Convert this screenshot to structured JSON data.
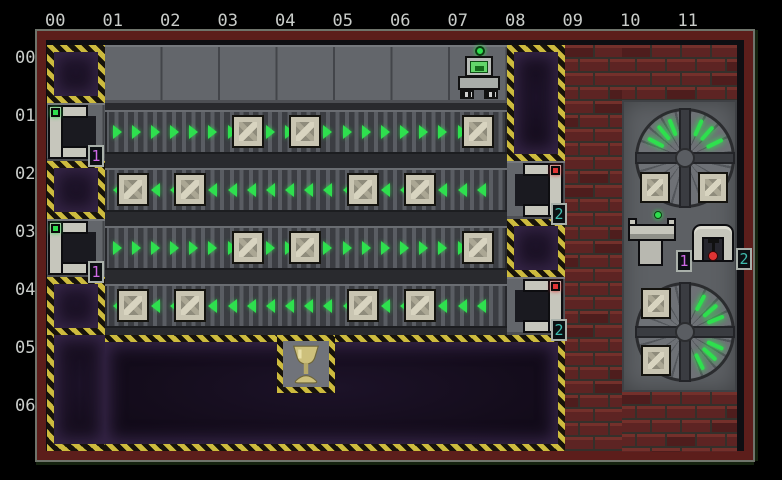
{
  "coordinates": {
    "columns": [
      "00",
      "01",
      "02",
      "03",
      "04",
      "05",
      "06",
      "07",
      "08",
      "09",
      "10",
      "11"
    ],
    "rows": [
      "00",
      "01",
      "02",
      "03",
      "04",
      "05",
      "06"
    ]
  },
  "colors": {
    "green": "#2ee04e",
    "hazard_yellow": "#cdbb3e",
    "magenta": "#cf6ae6",
    "teal": "#3fbcae",
    "led_red": "#e03434",
    "label_gray": "#c9ccc9",
    "frame_red": "#5c1e1b"
  },
  "board": {
    "robot": {
      "col": 7,
      "row": 0
    },
    "goal": {
      "col": 4,
      "row": 5,
      "item": "goblet"
    },
    "floors": [
      {
        "col": 1,
        "row": 0,
        "w": 7,
        "h": 1
      },
      {
        "col": 0,
        "row": 1,
        "w": 1,
        "h": 1
      },
      {
        "col": 0,
        "row": 3,
        "w": 1,
        "h": 1
      },
      {
        "col": 8,
        "row": 2,
        "w": 1,
        "h": 1
      },
      {
        "col": 8,
        "row": 4,
        "w": 1,
        "h": 1
      }
    ],
    "conveyors": [
      {
        "row": 1,
        "col_start": 1,
        "col_end": 7,
        "direction": "right"
      },
      {
        "row": 2,
        "col_start": 1,
        "col_end": 7,
        "direction": "left"
      },
      {
        "row": 3,
        "col_start": 1,
        "col_end": 7,
        "direction": "right"
      },
      {
        "row": 4,
        "col_start": 1,
        "col_end": 7,
        "direction": "left"
      }
    ],
    "pits": [
      {
        "col": 0,
        "row": 0,
        "w": 1,
        "h": 1,
        "borders": "1111"
      },
      {
        "col": 8,
        "row": 0,
        "w": 1,
        "h": 2,
        "borders": "1111"
      },
      {
        "col": 0,
        "row": 2,
        "w": 1,
        "h": 1,
        "borders": "1111"
      },
      {
        "col": 8,
        "row": 3,
        "w": 1,
        "h": 1,
        "borders": "1111"
      },
      {
        "col": 0,
        "row": 4,
        "w": 1,
        "h": 1,
        "borders": "1111"
      },
      {
        "col": 0,
        "row": 5,
        "w": 1,
        "h": 2,
        "borders": "0011"
      },
      {
        "col": 1,
        "row": 5,
        "w": 8,
        "h": 2,
        "borders": "1110"
      }
    ],
    "crates": [
      {
        "col": 3,
        "row": 1
      },
      {
        "col": 4,
        "row": 1
      },
      {
        "col": 7,
        "row": 1
      },
      {
        "col": 1,
        "row": 2
      },
      {
        "col": 2,
        "row": 2
      },
      {
        "col": 5,
        "row": 2
      },
      {
        "col": 6,
        "row": 2
      },
      {
        "col": 3,
        "row": 3
      },
      {
        "col": 4,
        "row": 3
      },
      {
        "col": 7,
        "row": 3
      },
      {
        "col": 1,
        "row": 4
      },
      {
        "col": 2,
        "row": 4
      },
      {
        "col": 5,
        "row": 4
      },
      {
        "col": 6,
        "row": 4
      }
    ],
    "dispensers": [
      {
        "col": 0,
        "row": 1,
        "label": "1"
      },
      {
        "col": 0,
        "row": 3,
        "label": "1"
      }
    ],
    "receivers": [
      {
        "col": 8,
        "row": 2,
        "label": "2"
      },
      {
        "col": 8,
        "row": 4,
        "label": "2"
      }
    ],
    "bricks": [
      {
        "col": 9,
        "row": 0,
        "w": 1,
        "h": 7
      },
      {
        "col": 10,
        "row": 0,
        "w": 2,
        "h": 0.95
      },
      {
        "col": 10,
        "row": 5.99,
        "w": 2,
        "h": 1.02
      }
    ]
  },
  "panel": {
    "crates": [
      "top-fan-left",
      "top-fan-right",
      "bottom-fan-upper",
      "bottom-fan-lower"
    ],
    "legend": [
      {
        "label": "1",
        "name": "dispenser chute"
      },
      {
        "label": "2",
        "name": "press machine"
      }
    ]
  }
}
